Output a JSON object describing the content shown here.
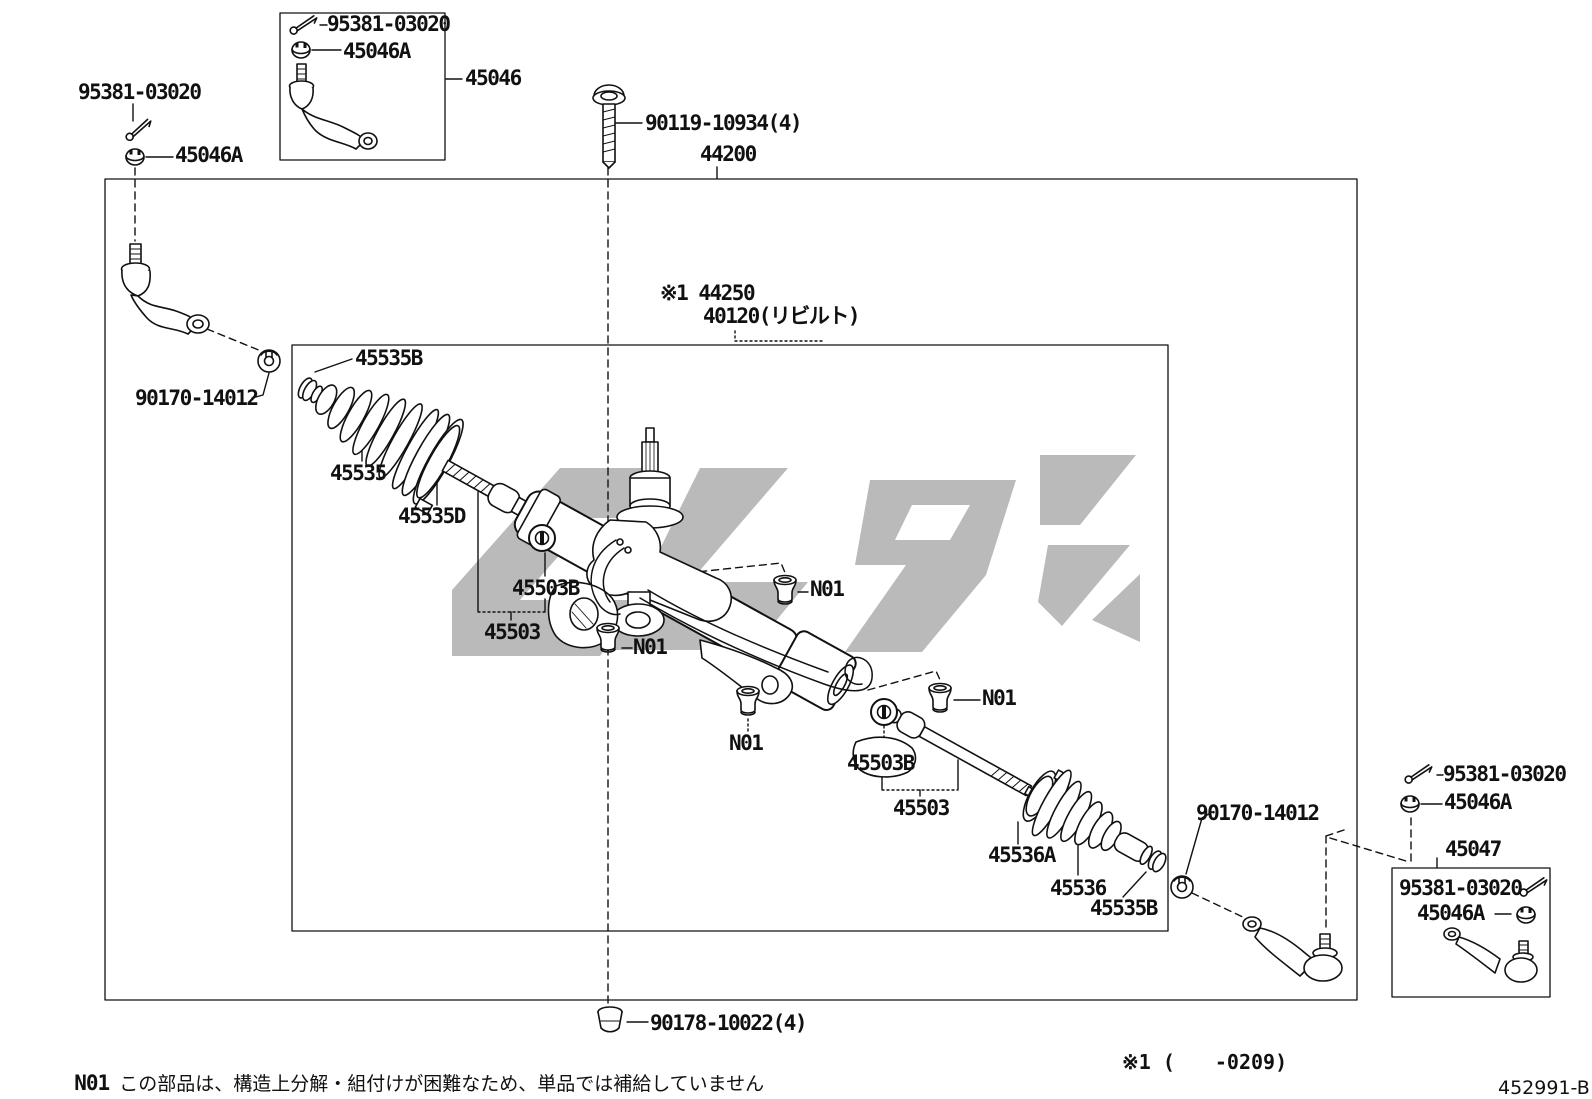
{
  "figure": {
    "type": "parts-diagram",
    "subject": "steering gear & link",
    "watermark_color": "#a9a9a9",
    "line_color": "#111111"
  },
  "callouts": {
    "tl_pin": "95381-03020",
    "tl_nut": "45046A",
    "topbox_pin": "95381-03020",
    "topbox_nut": "45046A",
    "tie_rod_end_lh": "45046",
    "mount_bolt": "90119-10934(4)",
    "gear_assy": "44200",
    "gear_link_assy": "※1 44250",
    "gear_link_reman": "40120(リビルト)",
    "boot_clamp_lh_small": "45535B",
    "lock_nut_lh": "90170-14012",
    "boot_lh": "45535",
    "boot_clamp_lh_large": "45535D",
    "claw_washer_lh": "45503B",
    "rack_end_lh": "45503",
    "grommet_a": "N01",
    "grommet_b": "N01",
    "grommet_c": "N01",
    "grommet_d": "N01",
    "claw_washer_rh": "45503B",
    "rack_end_rh": "45503",
    "boot_clamp_rh_large": "45536A",
    "boot_rh": "45536",
    "boot_clamp_rh_small": "45535B",
    "lock_nut_rh": "90170-14012",
    "r_pin": "95381-03020",
    "r_nut": "45046A",
    "tie_rod_end_rh": "45047",
    "rbox_pin": "95381-03020",
    "rbox_nut": "45046A",
    "lock_washer_bottom": "90178-10022(4)"
  },
  "footer": {
    "note_label": "N01",
    "note_text": "この部品は、構造上分解・組付けが困難なため、単品では補給していません",
    "applicability": "※1 (　　-0209)",
    "figure_code": "452991-B"
  }
}
